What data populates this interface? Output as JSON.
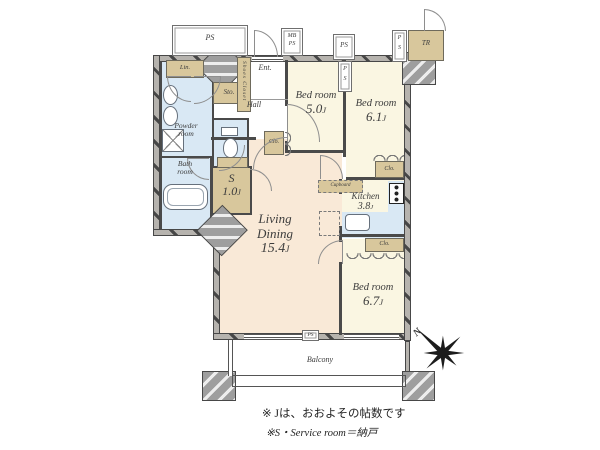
{
  "rooms": {
    "living": {
      "line1": "Living",
      "line2": "Dining",
      "area": "15.4",
      "area_unit": "J"
    },
    "bed5": {
      "name": "Bed room",
      "area": "5.0",
      "area_unit": "J"
    },
    "bed61": {
      "name": "Bed room",
      "area": "6.1",
      "area_unit": "J"
    },
    "bed67": {
      "name": "Bed room",
      "area": "6.7",
      "area_unit": "J"
    },
    "kitchen": {
      "name": "Kitchen",
      "area": "3.8",
      "area_unit": "J"
    },
    "service_room": {
      "name": "S",
      "area": "1.0",
      "area_unit": "J"
    },
    "powder": {
      "line1": "Powder",
      "line2": "room"
    },
    "bath": {
      "line1": "Bath",
      "line2": "room"
    },
    "hall": {
      "name": "Hall"
    },
    "entrance": {
      "name": "Ent."
    },
    "balcony": {
      "name": "Balcony"
    }
  },
  "closets": {
    "linen": "Lin.",
    "sto": "Sto.",
    "shoes": "Shoes Closet",
    "clo": "Clo.",
    "cupboard": "Cupboard",
    "trunk": "TR"
  },
  "shafts": {
    "ps": "PS",
    "mb": "MB",
    "p": "P",
    "s": "S"
  },
  "compass": {
    "north": "N"
  },
  "footnotes": {
    "line1": "※ Jは、おおよその帖数です",
    "line2": "※S・Service room＝納戸"
  },
  "colors": {
    "bedroom_fill": "#faf6e2",
    "living_fill": "#f9e9d7",
    "wet_fill": "#d9e8f4",
    "closet_fill": "#d8c79c",
    "wall_fill": "#b6b3ae"
  }
}
